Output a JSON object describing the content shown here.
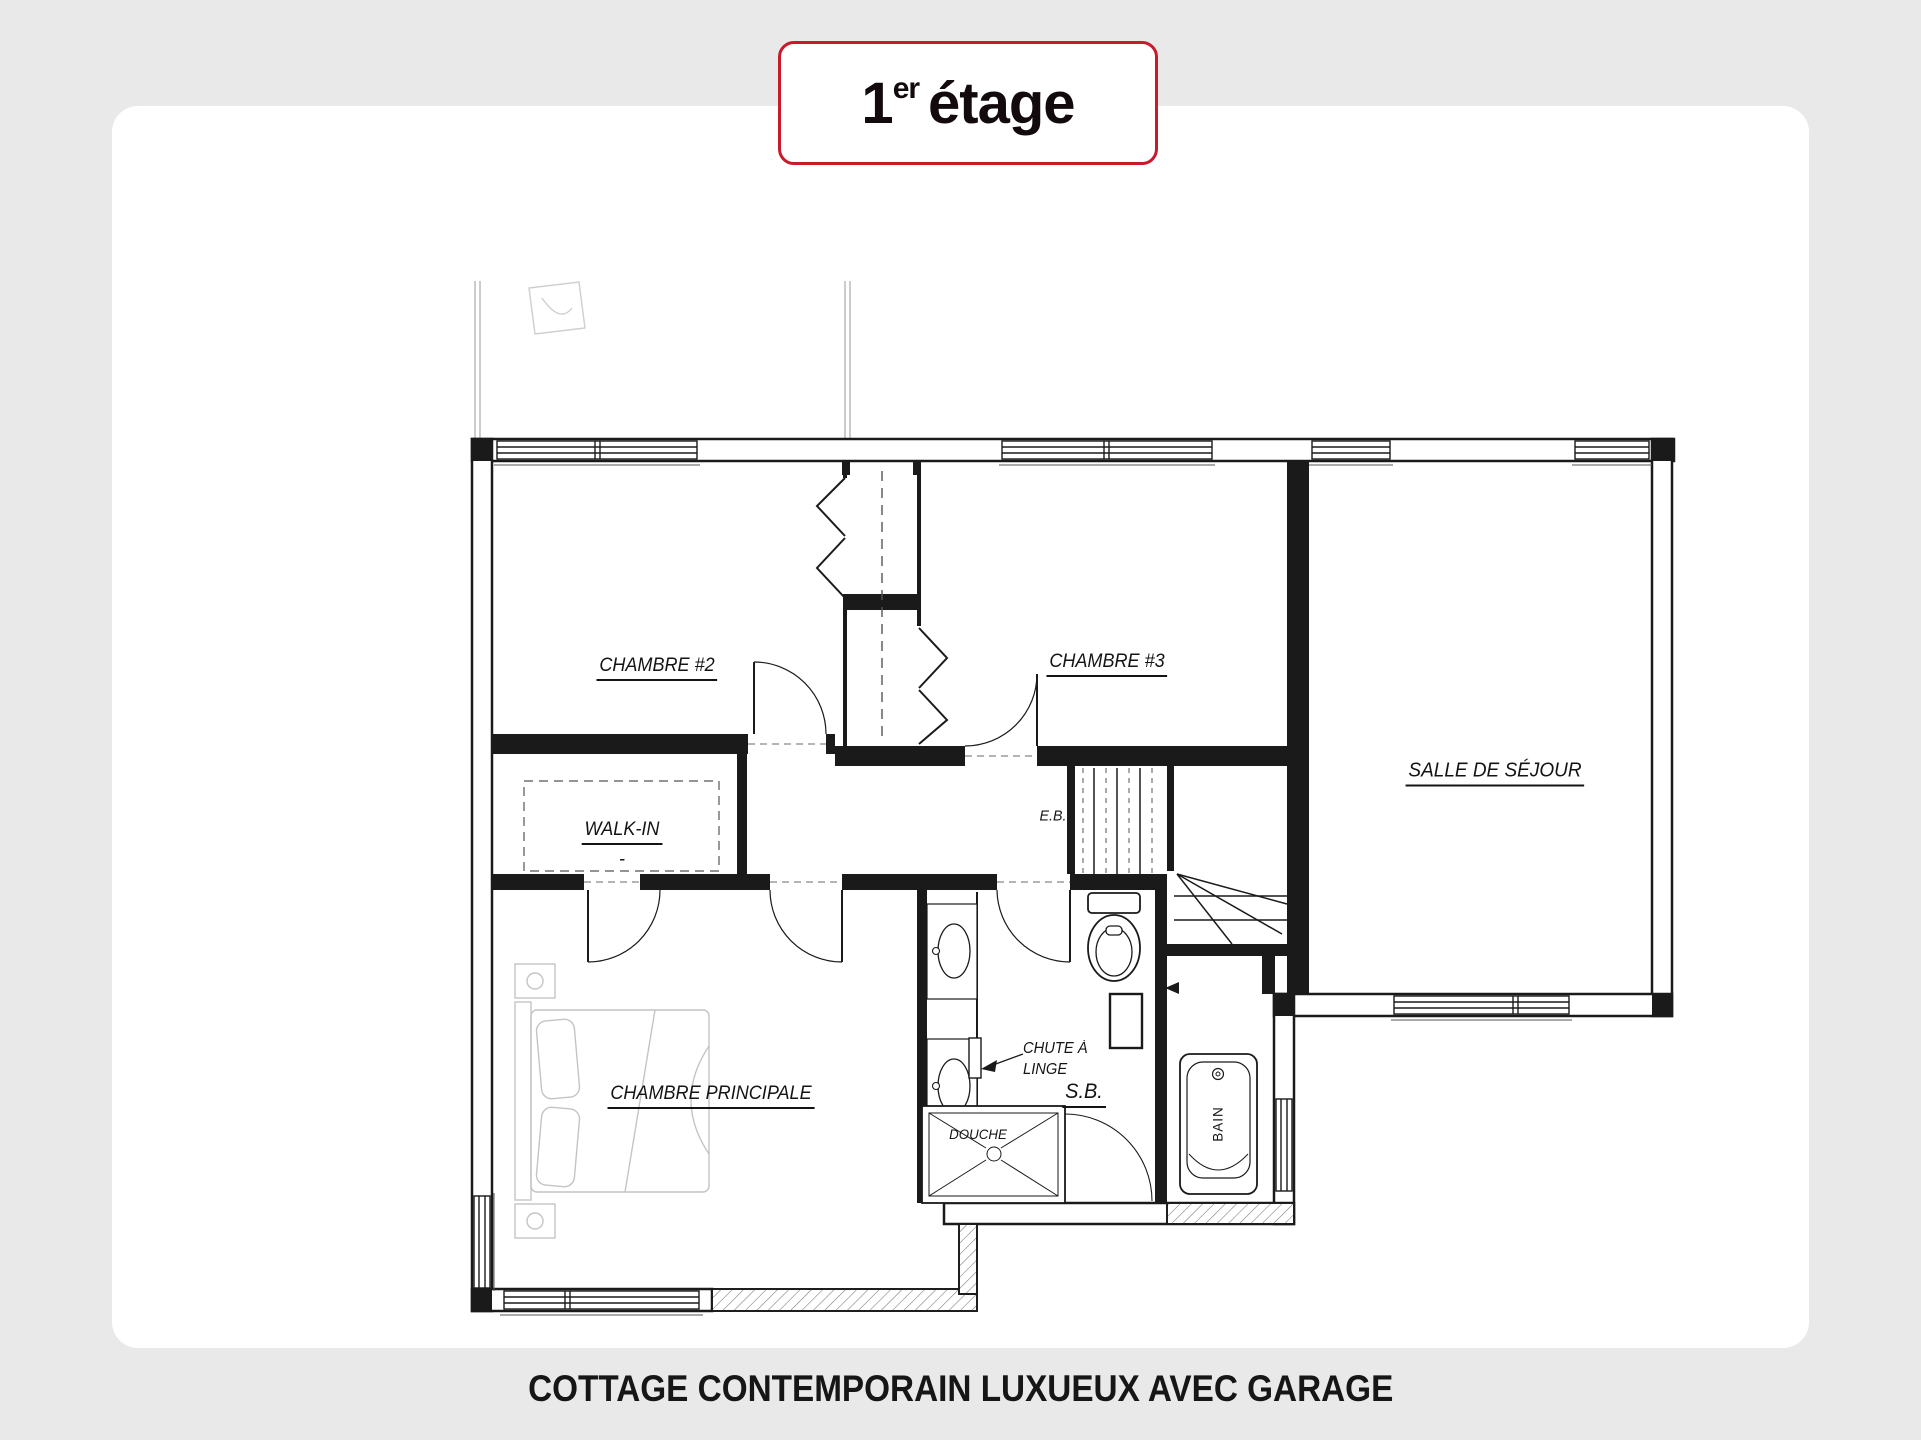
{
  "page": {
    "background_color": "#e9e9e9",
    "card_color": "#ffffff"
  },
  "title_badge": {
    "number": "1",
    "ordinal_suffix": "er",
    "word": "étage",
    "border_color": "#c81a2b"
  },
  "caption": {
    "text": "COTTAGE CONTEMPORAIN LUXUEUX AVEC GARAGE"
  },
  "floor_plan": {
    "line_color": "#1a1a1a",
    "labels": {
      "chambre2": "CHAMBRE #2",
      "chambre3": "CHAMBRE #3",
      "sejour": "SALLE DE SÉJOUR",
      "walkin": "WALK-IN",
      "walkin_dash": "-",
      "principale": "CHAMBRE PRINCIPALE",
      "eb": "E.B.",
      "chute_line1": "CHUTE À",
      "chute_line2": "LINGE",
      "sb": "S.B.",
      "douche": "DOUCHE",
      "bain": "BAIN"
    }
  }
}
